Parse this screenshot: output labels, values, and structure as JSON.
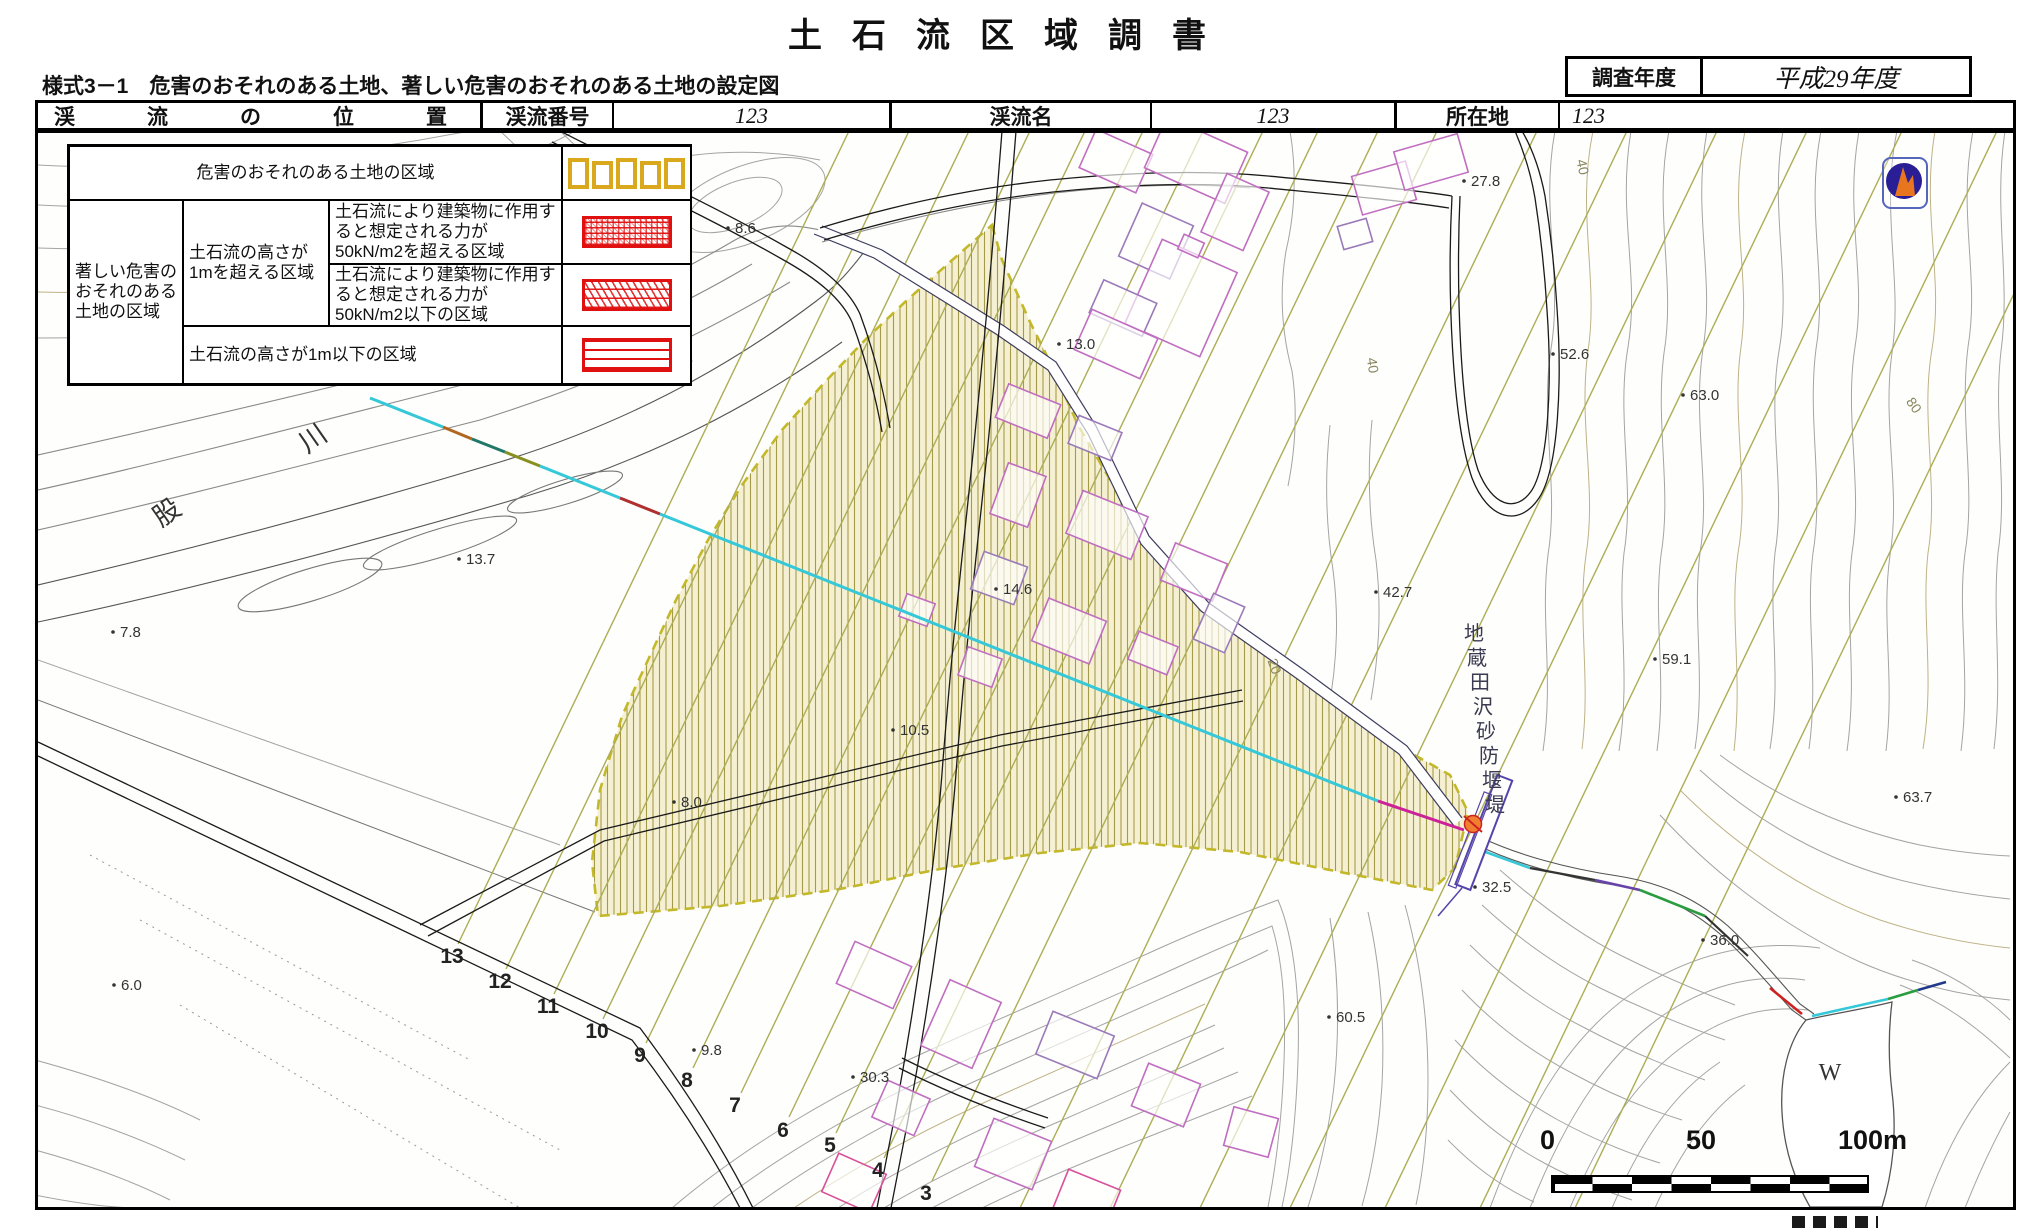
{
  "title": "土石流区域調書",
  "form_note": "様式3－1　危害のおそれのある土地、著しい危害のおそれのある土地の設定図",
  "survey_year": {
    "label": "調査年度",
    "value": "平成29年度"
  },
  "stream_table": {
    "position_label": "渓流の位置",
    "no_label": "渓流番号",
    "no_value": "123",
    "name_label": "渓流名",
    "name_value": "123",
    "loc_label": "所在地",
    "loc_value": "123"
  },
  "legend": {
    "row1": "危害のおそれのある土地の区域",
    "left": "著しい危害のおそれのある土地の区域",
    "mid": "土石流の高さが1mを超える区域",
    "row2": "土石流により建築物に作用すると想定される力が50kN/m2を超える区域",
    "row3": "土石流により建築物に作用すると想定される力が50kN/m2以下の区域",
    "row4": "土石流の高さが1m以下の区域"
  },
  "scale_bar": {
    "zero": "0",
    "fifty": "50",
    "hundred": "100m"
  },
  "map": {
    "dam_name": "地蔵田沢砂防堰堤",
    "pond_label": "W",
    "river_name_chars": [
      {
        "x": 172,
        "y": 520,
        "t": "股",
        "rot": -35
      },
      {
        "x": 318,
        "y": 446,
        "t": "川",
        "rot": -35
      }
    ],
    "spot_elevations": [
      {
        "x": 737,
        "y": 233,
        "v": "8.6"
      },
      {
        "x": 1473,
        "y": 186,
        "v": "27.8"
      },
      {
        "x": 1068,
        "y": 349,
        "v": "13.0"
      },
      {
        "x": 1562,
        "y": 359,
        "v": "52.6"
      },
      {
        "x": 1692,
        "y": 400,
        "v": "63.0"
      },
      {
        "x": 468,
        "y": 564,
        "v": "13.7"
      },
      {
        "x": 122,
        "y": 637,
        "v": "7.8"
      },
      {
        "x": 1385,
        "y": 597,
        "v": "42.7"
      },
      {
        "x": 1664,
        "y": 664,
        "v": "59.1"
      },
      {
        "x": 1905,
        "y": 802,
        "v": "63.7"
      },
      {
        "x": 683,
        "y": 807,
        "v": "8.0"
      },
      {
        "x": 902,
        "y": 735,
        "v": "10.5"
      },
      {
        "x": 1005,
        "y": 594,
        "v": "14.6"
      },
      {
        "x": 703,
        "y": 1055,
        "v": "9.8"
      },
      {
        "x": 862,
        "y": 1082,
        "v": "30.3"
      },
      {
        "x": 1338,
        "y": 1022,
        "v": "60.5"
      },
      {
        "x": 1712,
        "y": 945,
        "v": "36.0"
      },
      {
        "x": 1484,
        "y": 892,
        "v": "32.5"
      },
      {
        "x": 123,
        "y": 990,
        "v": "6.0"
      }
    ],
    "section_numbers": [
      {
        "x": 926,
        "y": 1200,
        "v": "3"
      },
      {
        "x": 878,
        "y": 1177,
        "v": "4"
      },
      {
        "x": 830,
        "y": 1152,
        "v": "5"
      },
      {
        "x": 783,
        "y": 1137,
        "v": "6"
      },
      {
        "x": 735,
        "y": 1112,
        "v": "7"
      },
      {
        "x": 687,
        "y": 1087,
        "v": "8"
      },
      {
        "x": 640,
        "y": 1062,
        "v": "9"
      },
      {
        "x": 597,
        "y": 1038,
        "v": "10"
      },
      {
        "x": 548,
        "y": 1013,
        "v": "11"
      },
      {
        "x": 500,
        "y": 988,
        "v": "12"
      },
      {
        "x": 452,
        "y": 963,
        "v": "13"
      }
    ],
    "contour_labels": [
      {
        "x": 1578,
        "y": 168,
        "v": "40",
        "rot": 78
      },
      {
        "x": 1910,
        "y": 408,
        "v": "80",
        "rot": 55
      },
      {
        "x": 1368,
        "y": 366,
        "v": "40",
        "rot": 82
      },
      {
        "x": 1270,
        "y": 668,
        "v": "20",
        "rot": 70
      }
    ]
  },
  "colors": {
    "hazard_hatch": "#a59a4a",
    "hazard_border": "#c3b82a",
    "danger_red": "#e01010",
    "legend_yellow": "#d9a81c",
    "survey_line_cyan": "#35c8d8",
    "section_line_olive": "#adad55"
  }
}
